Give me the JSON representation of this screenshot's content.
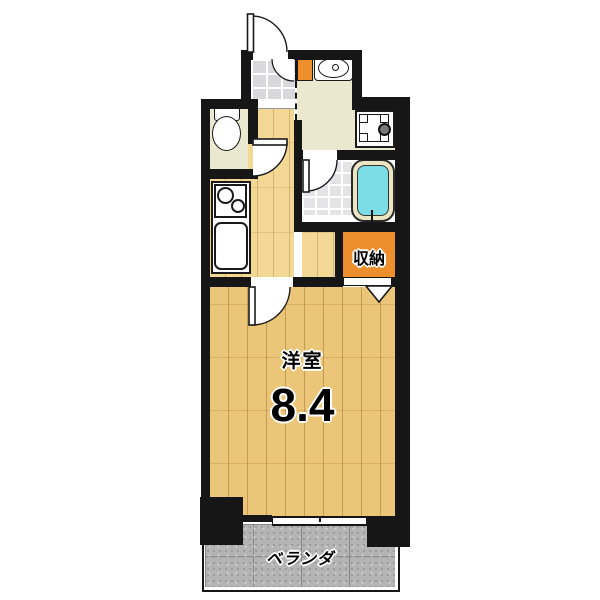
{
  "plan_title": "1K apartment floor plan",
  "rooms": {
    "main_room": {
      "name": "洋室",
      "size": "8.4"
    },
    "storage": {
      "name": "収納"
    },
    "veranda": {
      "name": "ベランダ"
    }
  },
  "fixtures": [
    "entrance-door",
    "genkan-tiles",
    "shoe-cabinet",
    "washbasin",
    "washing-machine",
    "toilet",
    "kitchen-stove",
    "kitchen-sink",
    "bathtub",
    "bathroom-door",
    "toilet-door",
    "main-room-door",
    "closet-folding-door",
    "window",
    "pillar"
  ],
  "colors": {
    "wall": "#161616",
    "wood_main_room": "#ecc678",
    "wood_hallway": "#f3d795",
    "cream_room_floor": "#eae8ce",
    "accent_orange": "#ee8f2e",
    "bathtub_water": "#7cdde6",
    "bathtub_rim": "#ece5c2",
    "genkan_tile": "#d9d9dd",
    "veranda_gray": "#b4b4b4",
    "background": "#ffffff"
  }
}
